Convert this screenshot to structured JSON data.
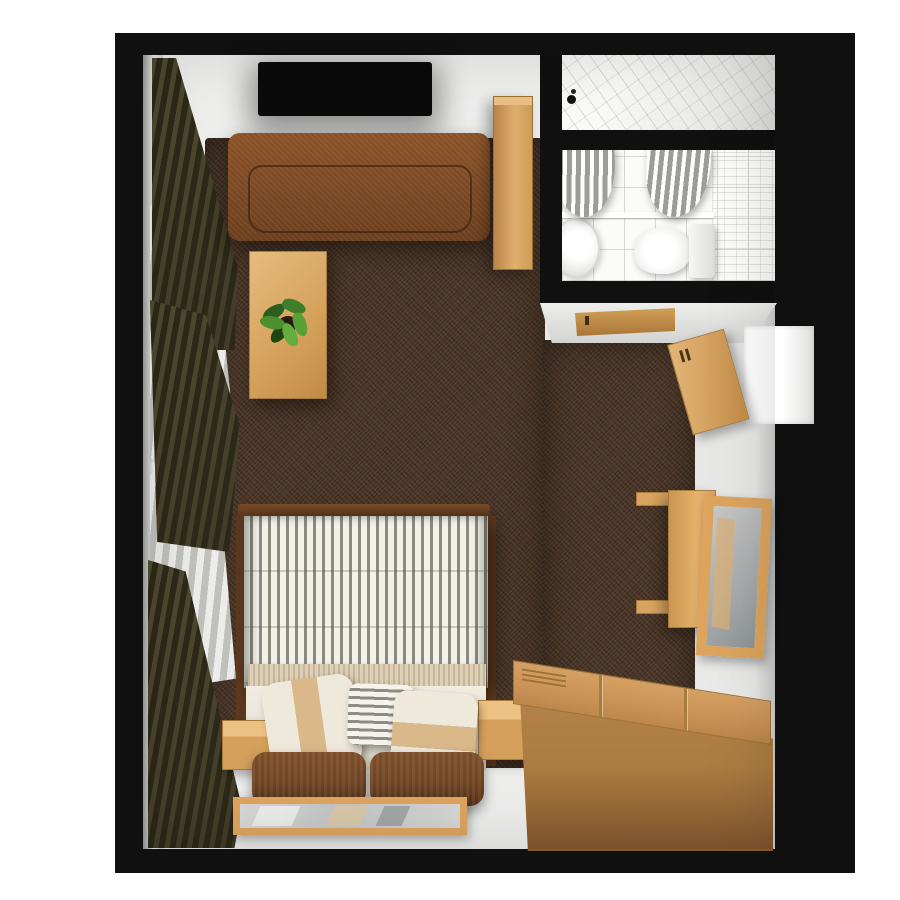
{
  "scene": {
    "title": "Top-down 3D floor plan of a hotel room with en-suite bathroom",
    "view": "top-down",
    "canvas_px": {
      "width": 900,
      "height": 900
    }
  },
  "rooms": [
    {
      "id": "main-room",
      "label": "Main room with double bed, sofa, TV, desk and wardrobe"
    },
    {
      "id": "bathroom",
      "label": "En-suite bathroom with shower stall, washbasin and toilet"
    }
  ],
  "labels": {
    "canvas": "Top-down 3D floor plan of a hotel room",
    "walls": "Black exterior walls",
    "carpet": "Dark brown carpet",
    "windows": "Left-wall windows with sheer and olive curtains",
    "curtain-sheer": "Sheer white curtain",
    "curtain-olive": "Olive drape",
    "tv": "Wall-mounted flat-screen TV",
    "sofa": "Brown fabric sofa",
    "coffee-table": "Light wood coffee table",
    "plant": "Potted green plant",
    "closet": "Tall wooden cabinet beside bathroom",
    "shower": "Tiled shower stall with shower head",
    "bathroom-floor": "Tiled bathroom floor",
    "shower-curtain-left": "Shower curtain (left)",
    "shower-curtain-right": "Shower curtain (right)",
    "tub-edge": "Bath / shower ledge",
    "sink": "Washbasin",
    "toilet-bowl": "Toilet bowl",
    "toilet-tank": "Toilet cistern",
    "bathroom-door": "Bathroom door",
    "entry-door": "Entry door standing ajar",
    "doorway": "Entry doorway in right wall",
    "desk": "Wooden console desk on right wall",
    "wall-mirror": "Wood-framed mirror on right wall",
    "wardrobe": "Large wooden wardrobe with panel doors",
    "bed": "Double bed with grey striped duvet",
    "blanket": "Folded beige throw blanket",
    "pillow-left": "Cream pillow with tan stripe",
    "pillow-center": "Grey striped cushion",
    "pillow-right": "Cream pillow with tan band",
    "headboard": "Brown upholstered headboard",
    "nightstand-left": "Left bedside cabinet",
    "nightstand-right": "Right bedside cabinet",
    "floor-mirror": "Wood-framed mirror along bottom wall",
    "bed-frame": "Dark wood bed frame"
  },
  "colors": {
    "background": "#ffffff",
    "wall": "#101010",
    "floor": "#e9e9e8",
    "carpet": "#4a3526",
    "sofa": "#7c4825",
    "wood-light": "#e0ad67",
    "wood-mid": "#cd9a55",
    "wardrobe-top": "#c99257",
    "wardrobe-front": "#ad7c42",
    "curtain-olive": "#433e29",
    "curtain-sheer": "#d7d7d4",
    "duvet-light": "#f2f1ea",
    "duvet-dark": "#8b8b80",
    "pillow-cream": "#efe9dc",
    "pillow-tan": "#d9b88a",
    "headboard": "#6f4526",
    "tile": "#f2f2f1",
    "fixture": "#fbfbfa",
    "mirror-glass": "#a7abac",
    "door-tan": "#d3a05c",
    "plant": "#3f7d28",
    "tv": "#0b0b0b"
  }
}
